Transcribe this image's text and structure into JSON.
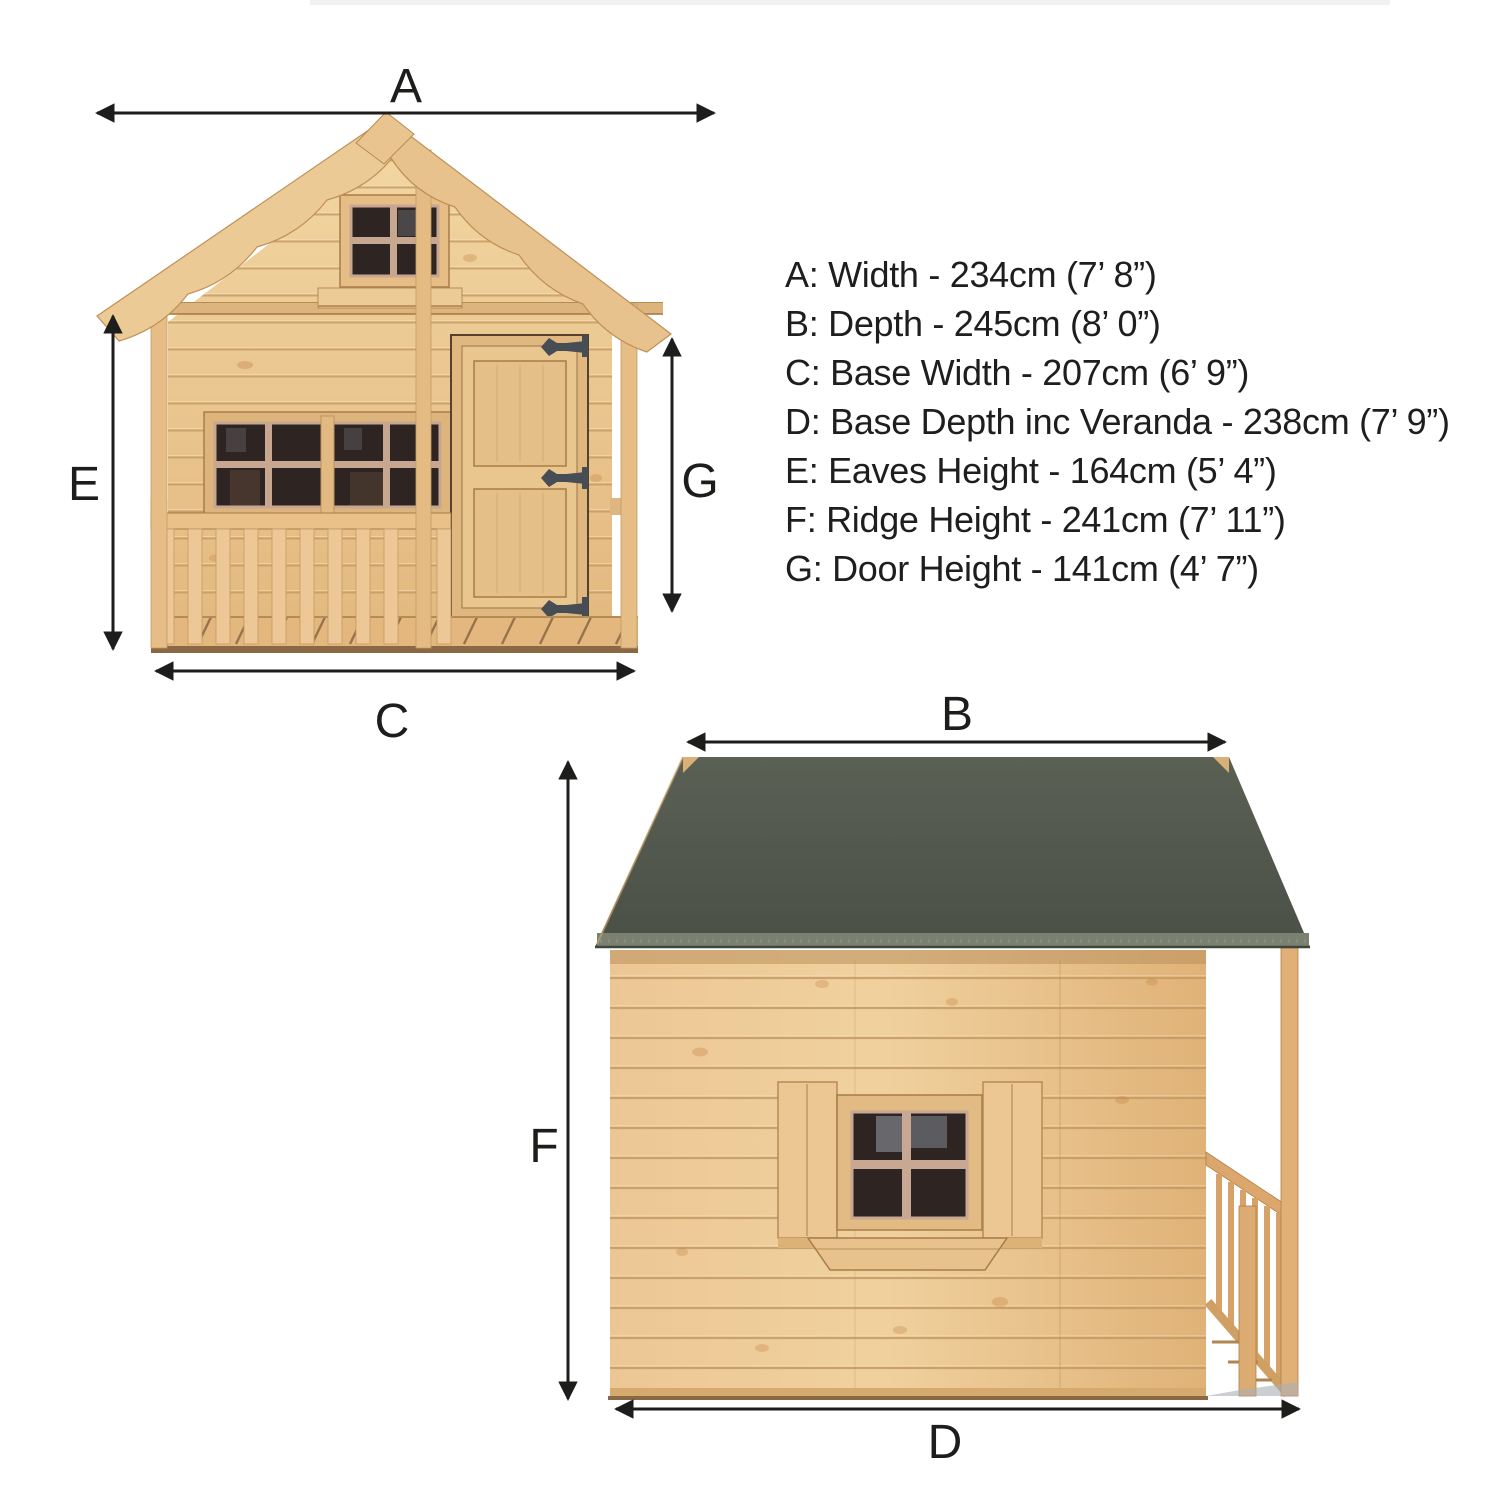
{
  "page": {
    "background": "#ffffff"
  },
  "colors": {
    "wood": "#e8c28c",
    "wood_light": "#f2d6a2",
    "wood_line": "#c49a63",
    "wood_deep": "#8a6844",
    "roof": "#50564b",
    "roof_edge": "#7a8171",
    "window_pane": "#2e2522",
    "glass_reflection": "#8e959e",
    "muntin": "#c8a790",
    "hinge": "#474d55",
    "ink": "#1d1d1b"
  },
  "front_view": {
    "width_label": "A",
    "base_width_label": "C",
    "eaves_height_label": "E",
    "door_height_label": "G"
  },
  "side_view": {
    "depth_label": "B",
    "base_depth_label": "D",
    "ridge_height_label": "F"
  },
  "specs": {
    "lines": [
      "A: Width - 234cm (7’ 8”)",
      "B: Depth - 245cm (8’ 0”)",
      "C: Base Width - 207cm (6’ 9”)",
      "D: Base Depth inc Veranda - 238cm (7’ 9”)",
      "E: Eaves Height - 164cm (5’ 4”)",
      "F: Ridge Height - 241cm (7’ 11”)",
      "G: Door Height - 141cm (4’ 7”)"
    ]
  }
}
